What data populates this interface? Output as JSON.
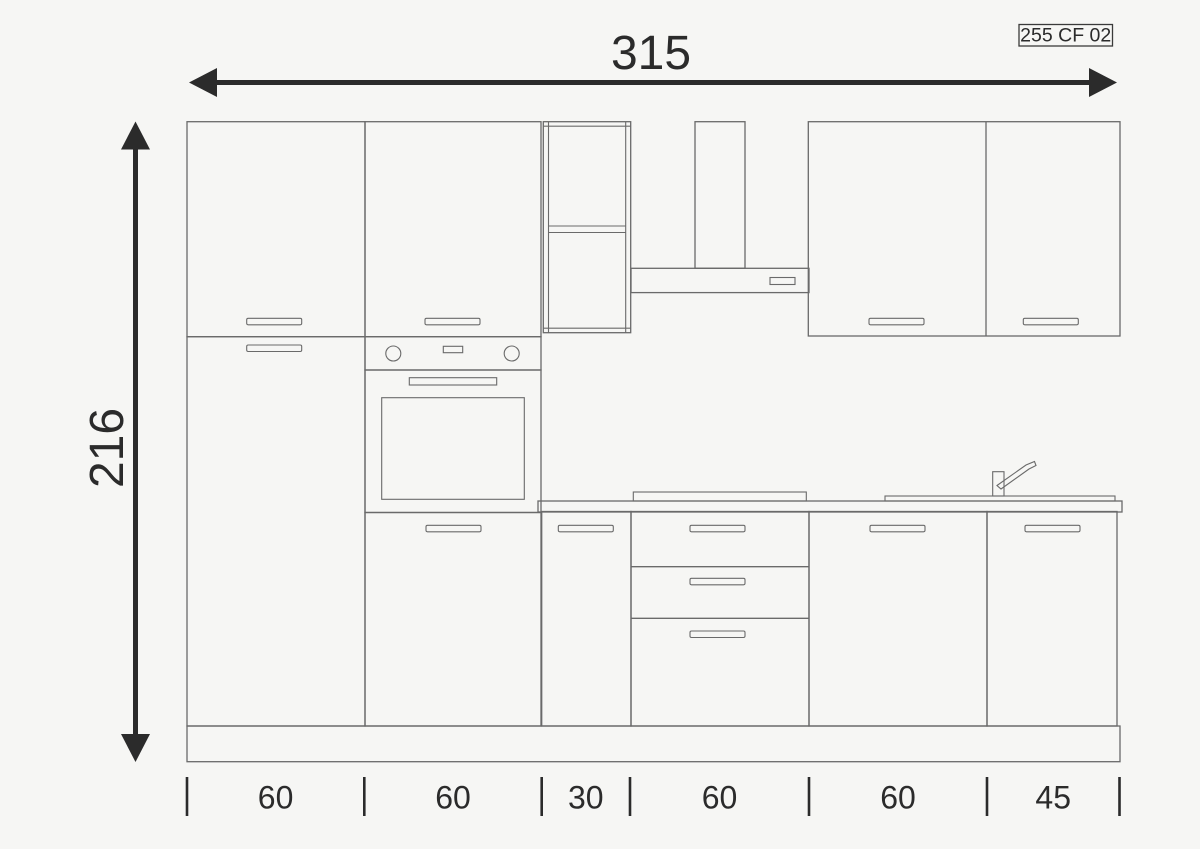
{
  "document": {
    "code_label": "255 CF 02"
  },
  "dimensions": {
    "total_width_cm": "315",
    "total_height_cm": "216",
    "unit": "cm",
    "segments": [
      {
        "value": "60"
      },
      {
        "value": "60"
      },
      {
        "value": "30"
      },
      {
        "value": "60"
      },
      {
        "value": "60"
      },
      {
        "value": "45"
      }
    ]
  },
  "colors": {
    "background": "#f6f6f4",
    "drawing_outline": "#6a6a6a",
    "dimension_marks": "#2b2b2b"
  }
}
